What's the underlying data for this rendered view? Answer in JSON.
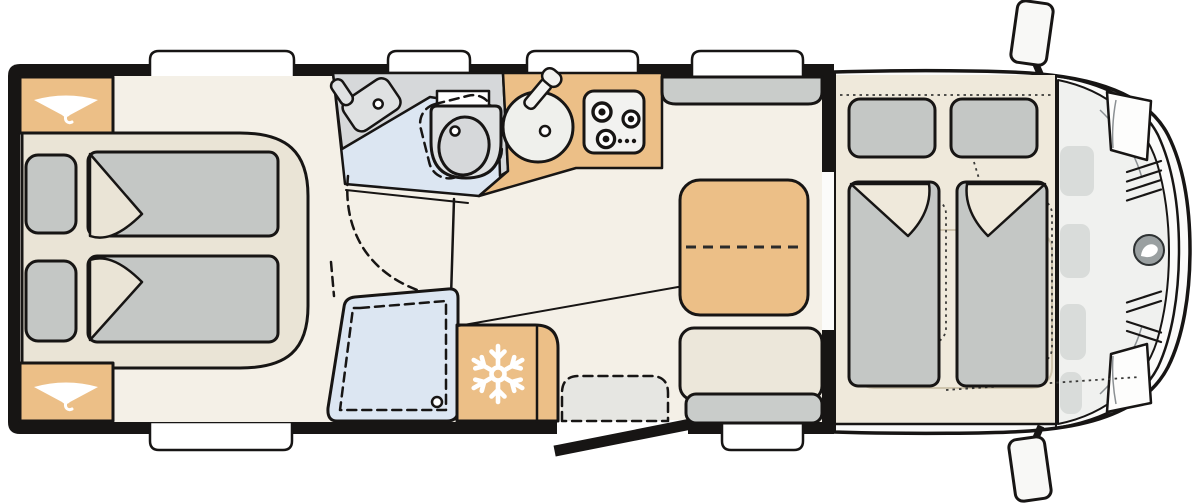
{
  "meta": {
    "title": "Motorhome floor plan - top view",
    "diagram_type": "vehicle floor plan",
    "orientation": "cab on the right, rear bedroom on the left"
  },
  "colors": {
    "background": "#ffffff",
    "wall": "#171514",
    "floor": "#f4f0e7",
    "cab_floor": "#efe9db",
    "bed_platform": "#eae4d6",
    "cushion_gray": "#c4c7c5",
    "bench_gray": "#c9ccca",
    "unit_orange": "#ecbf87",
    "wet_room_blue": "#dce6f2",
    "bath_gray": "#d6d8da",
    "fixture_gray": "#dfe1e2",
    "sink_white": "#eff0ec",
    "step_gray": "#e6e6e2",
    "body_white": "#fbfbfa",
    "glass_gray": "#f0f1ef",
    "dashboard_gray": "#d9dcda",
    "logo_gray": "#9aa0a1",
    "platform_outline_tan": "#cfc5ae",
    "seat_cream": "#ece7da",
    "stove_white": "#f2f2f0",
    "mirror_white": "#f8f8f6",
    "headlight_white": "#fdfdfc",
    "icon_white": "#ffffff"
  },
  "areas": {
    "rear_bedroom": {
      "label": "Rear bedroom with two single beds",
      "beds": 2,
      "wardrobes": 2,
      "wardrobe_icon": "hanger-icon"
    },
    "bathroom": {
      "label": "Washroom with basin and swivel toilet"
    },
    "shower": {
      "label": "Shower cubicle with drain"
    },
    "kitchen": {
      "label": "Kitchen block with round sink and 3-burner hob",
      "burners": 3
    },
    "fridge": {
      "label": "Refrigerator",
      "icon": "snowflake-icon"
    },
    "entrance": {
      "label": "Entry door (shown open) with inner step",
      "door_state": "open"
    },
    "lounge": {
      "label": "Dinette with table, bench seat and side bench",
      "table_extension": "dashed split line"
    },
    "drop_down_bed": {
      "label": "Drop-down double bed above cab",
      "pillows": 2,
      "duvets": 2
    },
    "cab": {
      "label": "Driver cab with two swivelling seats (dotted outlines)",
      "badge": "d-logo",
      "mirrors": 2,
      "headlights": 2
    }
  },
  "openings": {
    "top_wall_windows": 4,
    "bottom_wall_windows": 2,
    "entry_door": 1
  }
}
